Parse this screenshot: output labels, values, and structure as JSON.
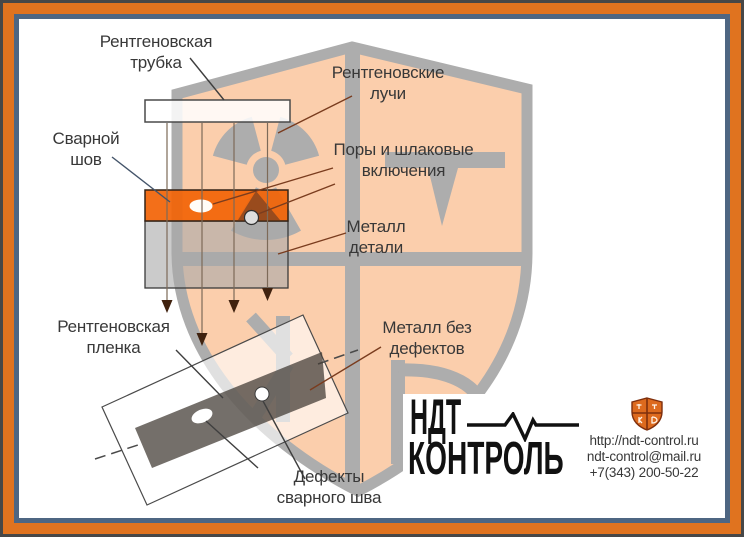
{
  "diagram": {
    "labels": {
      "xray_tube": "Рентгеновская\nтрубка",
      "xray_rays": "Рентгеновские\nлучи",
      "weld_seam": "Сварной\nшов",
      "pores_inclusions": "Поры и шлаковые\nвключения",
      "part_metal": "Металл\nдетали",
      "xray_film": "Рентгеновская\nпленка",
      "metal_no_defects": "Металл без\nдефектов",
      "weld_defects": "Дефекты\nсварного шва"
    },
    "colors": {
      "weld_orange": "#F26408",
      "shield_peach": "#FBCEAC",
      "shield_gray": "#ADADAD",
      "frame_orange": "#E0731F",
      "frame_slate": "#4E6682"
    }
  },
  "branding": {
    "logo_line1": "НДТ",
    "logo_line2": "КОНТРОЛЬ",
    "icons": {
      "pulse": "ecg-pulse-icon",
      "shield": "ndt-shield-icon",
      "watermark": "ndt-shield-watermark"
    },
    "website": "http://ndt-control.ru",
    "email": "ndt-control@mail.ru",
    "phone": "+7(343) 200-50-22"
  }
}
